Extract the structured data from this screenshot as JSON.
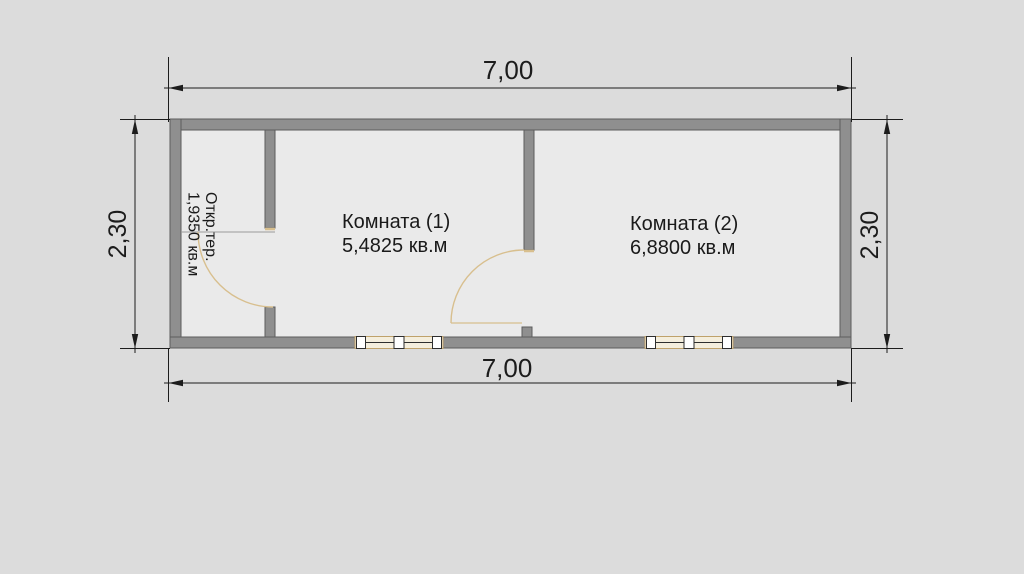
{
  "plan": {
    "dimensions": {
      "width_top": "7,00",
      "width_bottom": "7,00",
      "height_left": "2,30",
      "height_right": "2,30"
    },
    "rooms": [
      {
        "name": "Комната (1)",
        "area": "5,4825 кв.м"
      },
      {
        "name": "Комната (2)",
        "area": "6,8800 кв.м"
      }
    ],
    "terrace": {
      "name": "Откр.тер.",
      "area": "1,9350 кв.м"
    },
    "colors": {
      "background": "#dcdcdc",
      "floor": "#eaeaea",
      "wall_fill": "#8f8f8f",
      "wall_outline": "#5c5c5c",
      "dimension_color": "#1c1c1c",
      "text_color": "#1a1a1a",
      "door_color": "#d8bf8e",
      "window_frame": "#bfa26b",
      "window_fill": "#f4eedd"
    }
  }
}
